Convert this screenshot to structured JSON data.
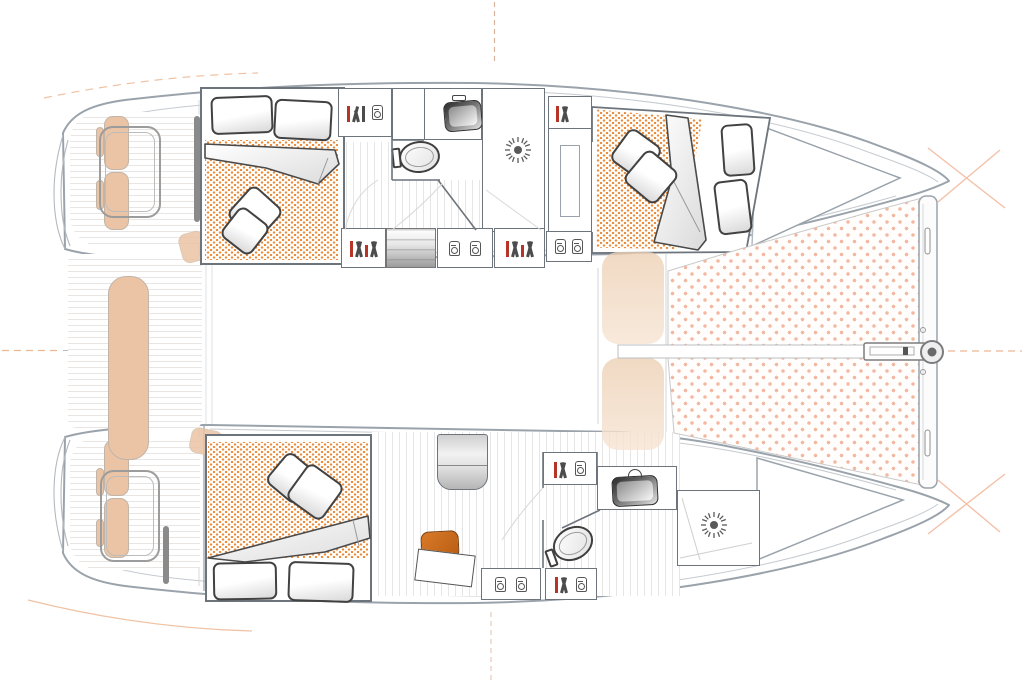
{
  "meta": {
    "kind": "catamaran-floor-plan",
    "view": "top-down accommodation and deck plan",
    "has_text": false
  },
  "colors": {
    "hull-line": "#9aa3ab",
    "wall-line": "#6d747c",
    "detail-line": "#c6cbd0",
    "mattress-dot": "#e98a3c",
    "trampoline-dot": "#f2b8a2",
    "cushion-tan": "#eac4a5",
    "chair-orange": "#c96a20",
    "accent-red": "#b73527",
    "floor-line": "#e6e6e6",
    "deck-line": "#e8e5e2",
    "guide-orange": "#f0c2a4"
  },
  "layout": {
    "port_hull_top": {
      "aft_cabin": {
        "furniture": [
          "double-berth",
          "two-head-pillows",
          "two-throw-pillows",
          "folded-duvet",
          "dotted-mattress"
        ]
      },
      "head": {
        "fixtures": [
          "vanity-sink",
          "toilet",
          "shower-with-drain"
        ]
      },
      "forward_cabin": {
        "furniture": [
          "angled-double-berth",
          "two-pillows",
          "two-throw-pillows",
          "folded-duvet",
          "locker-column"
        ]
      },
      "inboard_units": [
        "book-shelf",
        "companionway-steps",
        "cabinet-two-jars",
        "book-shelf",
        "unit-two-jars"
      ]
    },
    "starboard_hull_bottom": {
      "aft_cabin": {
        "furniture": [
          "double-berth",
          "two-head-pillows",
          "two-throw-pillows",
          "folded-duvet",
          "dotted-mattress",
          "desk",
          "orange-chair",
          "wardrobe"
        ]
      },
      "head": {
        "fixtures": [
          "vanity-sink",
          "toilet",
          "shower-with-drain",
          "book-shelves",
          "unit-two-jars"
        ]
      },
      "bow_locker": "triangular-forepeak"
    },
    "deck": {
      "stern": [
        "swim-steps",
        "transom-cushions",
        "deck-hatches",
        "cockpit-bench-cushion",
        "plank-decking"
      ],
      "amidships": "faded-salon-area",
      "foredeck": [
        "two-ghosted-sunpads",
        "port-trampoline",
        "starboard-trampoline",
        "center-walkway",
        "forward-crossbeam",
        "bowsprit-ring-fitting",
        "anchor-bar"
      ],
      "guides": [
        "dashed-centerline-horizontal",
        "dashed-mast-axis-vertical",
        "bow-cross-guides",
        "faint-sheerline-arcs"
      ]
    }
  },
  "icons": [
    "books-icon",
    "jar-icon",
    "sunburst-drain-icon",
    "toilet-icon",
    "sink-basin-icon",
    "pillow",
    "duvet",
    "trampoline-pattern",
    "mattress-pattern"
  ]
}
